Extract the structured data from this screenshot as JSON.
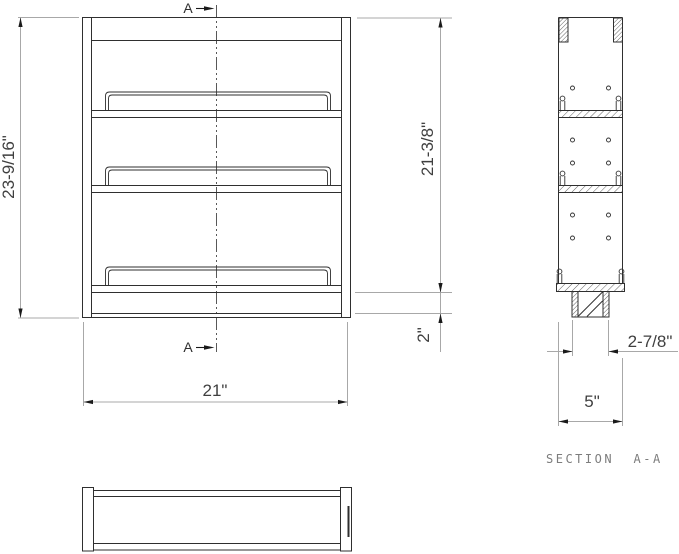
{
  "drawing": {
    "section_markers": {
      "top": "A",
      "bottom": "A"
    },
    "section_title": "SECTION  A-A",
    "dimensions": {
      "front_overall_height": "23-9/16\"",
      "front_shelf_height": "21-3/8\"",
      "front_base_height": "2\"",
      "front_width": "21\"",
      "section_base_width": "2-7/8\"",
      "section_depth": "5\""
    },
    "colors": {
      "object_line": "#2f2f2f",
      "dimension_line": "#a8a8a8",
      "dimension_text": "#3f3f3f",
      "section_title_text": "#7d7d7d",
      "background": "#ffffff"
    }
  }
}
